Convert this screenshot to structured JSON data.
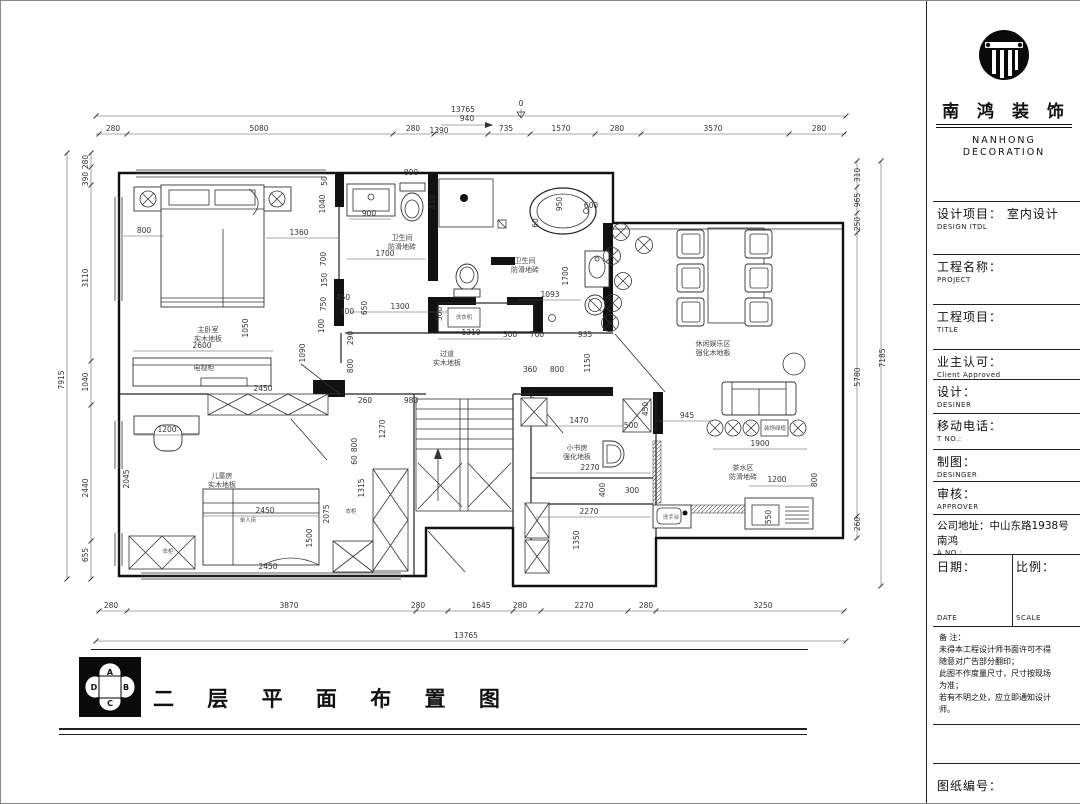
{
  "tb": {
    "company_cn": "南 鸿 装 饰",
    "company_en1": "NANHONG",
    "company_en2": "DECORATION",
    "rows": [
      {
        "label": "设计项目： 室内设计",
        "sub": "DESIGN ITDL"
      },
      {
        "label": "工程名称：",
        "sub": "PROJECT"
      },
      {
        "label": "工程项目：",
        "sub": "TITLE"
      },
      {
        "label": "业主认可：",
        "sub": "Client Approved"
      },
      {
        "label": "设计：",
        "sub": "DESINER"
      },
      {
        "label": "移动电话：",
        "sub": "T NO.:"
      },
      {
        "label": "制图：",
        "sub": "DESINGER"
      },
      {
        "label": "审核：",
        "sub": "APPROVER"
      },
      {
        "label": "公司地址：中山东路1938号南鸿",
        "sub": "A NO.:"
      }
    ],
    "date_label": "日期：",
    "date_sub": "DATE",
    "scale_label": "比例：",
    "scale_sub": "SCALE",
    "notes": "备  注：\n未得本工程设计师书面许可不得\n随意对广告部分翻印；\n此图不作度量尺寸，尺寸按现场\n为准；\n若有不明之处，应立即通知设计\n师。",
    "drawing_no_label": "图纸编号："
  },
  "footer": {
    "title": "二 层 平 面 布 置 图",
    "compass": {
      "a": "A",
      "b": "B",
      "c": "C",
      "d": "D"
    }
  },
  "plan": {
    "labels": [
      {
        "t": "13765",
        "x": 462,
        "y": 111
      },
      {
        "t": "0",
        "x": 520,
        "y": 105
      },
      {
        "t": "280",
        "x": 112,
        "y": 130
      },
      {
        "t": "5080",
        "x": 258,
        "y": 130
      },
      {
        "t": "280",
        "x": 412,
        "y": 130
      },
      {
        "t": "1390",
        "x": 438,
        "y": 132
      },
      {
        "t": "940",
        "x": 466,
        "y": 120
      },
      {
        "t": "735",
        "x": 505,
        "y": 130
      },
      {
        "t": "1570",
        "x": 560,
        "y": 130
      },
      {
        "t": "280",
        "x": 616,
        "y": 130
      },
      {
        "t": "3570",
        "x": 712,
        "y": 130
      },
      {
        "t": "280",
        "x": 818,
        "y": 130
      },
      {
        "t": "280",
        "x": 110,
        "y": 607
      },
      {
        "t": "3870",
        "x": 288,
        "y": 607
      },
      {
        "t": "280",
        "x": 417,
        "y": 607
      },
      {
        "t": "1645",
        "x": 480,
        "y": 607
      },
      {
        "t": "280",
        "x": 519,
        "y": 607
      },
      {
        "t": "2270",
        "x": 583,
        "y": 607
      },
      {
        "t": "280",
        "x": 645,
        "y": 607
      },
      {
        "t": "3250",
        "x": 762,
        "y": 607
      },
      {
        "t": "13765",
        "x": 465,
        "y": 637
      },
      {
        "t": "280",
        "x": 87,
        "y": 161,
        "r": -90
      },
      {
        "t": "390",
        "x": 87,
        "y": 178,
        "r": -90
      },
      {
        "t": "3110",
        "x": 87,
        "y": 277,
        "r": -90
      },
      {
        "t": "1040",
        "x": 87,
        "y": 381,
        "r": -90
      },
      {
        "t": "2440",
        "x": 87,
        "y": 487,
        "r": -90
      },
      {
        "t": "655",
        "x": 87,
        "y": 554,
        "r": -90
      },
      {
        "t": "7915",
        "x": 63,
        "y": 379,
        "r": -90
      },
      {
        "t": "310",
        "x": 859,
        "y": 174,
        "r": -90
      },
      {
        "t": "965",
        "x": 859,
        "y": 199,
        "r": -90
      },
      {
        "t": "250",
        "x": 859,
        "y": 223,
        "r": -90
      },
      {
        "t": "5780",
        "x": 859,
        "y": 376,
        "r": -90
      },
      {
        "t": "260",
        "x": 859,
        "y": 523,
        "r": -90
      },
      {
        "t": "7185",
        "x": 884,
        "y": 357,
        "r": -90
      },
      {
        "t": "800",
        "x": 143,
        "y": 232
      },
      {
        "t": "1360",
        "x": 298,
        "y": 234
      },
      {
        "t": "1040",
        "x": 324,
        "y": 203,
        "r": -90
      },
      {
        "t": "50",
        "x": 326,
        "y": 180,
        "r": -90
      },
      {
        "t": "700",
        "x": 325,
        "y": 258,
        "r": -90
      },
      {
        "t": "150",
        "x": 326,
        "y": 279,
        "r": -90
      },
      {
        "t": "750",
        "x": 325,
        "y": 303,
        "r": -90
      },
      {
        "t": "100",
        "x": 323,
        "y": 325,
        "r": -90
      },
      {
        "t": "1050",
        "x": 247,
        "y": 327,
        "r": -90
      },
      {
        "t": "2600",
        "x": 201,
        "y": 347
      },
      {
        "t": "1090",
        "x": 304,
        "y": 352,
        "r": -90
      },
      {
        "t": "290",
        "x": 352,
        "y": 337,
        "r": -90
      },
      {
        "t": "800",
        "x": 352,
        "y": 365,
        "r": -90
      },
      {
        "t": "900",
        "x": 368,
        "y": 215
      },
      {
        "t": "800",
        "x": 410,
        "y": 174
      },
      {
        "t": "1700",
        "x": 384,
        "y": 255
      },
      {
        "t": "450",
        "x": 342,
        "y": 299
      },
      {
        "t": "650",
        "x": 366,
        "y": 307,
        "r": -90
      },
      {
        "t": "300",
        "x": 346,
        "y": 313
      },
      {
        "t": "1300",
        "x": 399,
        "y": 308
      },
      {
        "t": "810",
        "x": 434,
        "y": 201,
        "r": -90
      },
      {
        "t": "1310",
        "x": 470,
        "y": 334
      },
      {
        "t": "500",
        "x": 441,
        "y": 313,
        "r": -90
      },
      {
        "t": "300",
        "x": 509,
        "y": 336
      },
      {
        "t": "700",
        "x": 536,
        "y": 336
      },
      {
        "t": "935",
        "x": 584,
        "y": 336
      },
      {
        "t": "1093",
        "x": 549,
        "y": 296
      },
      {
        "t": "950",
        "x": 561,
        "y": 203,
        "r": -90
      },
      {
        "t": "600",
        "x": 590,
        "y": 207
      },
      {
        "t": "60",
        "x": 537,
        "y": 222,
        "r": -90
      },
      {
        "t": "1700",
        "x": 567,
        "y": 275,
        "r": -90
      },
      {
        "t": "360",
        "x": 529,
        "y": 371
      },
      {
        "t": "800",
        "x": 556,
        "y": 371
      },
      {
        "t": "1150",
        "x": 589,
        "y": 362,
        "r": -90
      },
      {
        "t": "2450",
        "x": 262,
        "y": 390
      },
      {
        "t": "260",
        "x": 364,
        "y": 402
      },
      {
        "t": "980",
        "x": 410,
        "y": 402
      },
      {
        "t": "1270",
        "x": 384,
        "y": 428,
        "r": -90
      },
      {
        "t": "800",
        "x": 356,
        "y": 444,
        "r": -90
      },
      {
        "t": "60",
        "x": 356,
        "y": 459,
        "r": -90
      },
      {
        "t": "1200",
        "x": 166,
        "y": 431
      },
      {
        "t": "2045",
        "x": 128,
        "y": 478,
        "r": -90
      },
      {
        "t": "2450",
        "x": 264,
        "y": 512
      },
      {
        "t": "1500",
        "x": 311,
        "y": 537,
        "r": -90
      },
      {
        "t": "2075",
        "x": 328,
        "y": 513,
        "r": -90
      },
      {
        "t": "2450",
        "x": 267,
        "y": 568
      },
      {
        "t": "1315",
        "x": 363,
        "y": 487,
        "r": -90
      },
      {
        "t": "1470",
        "x": 578,
        "y": 422
      },
      {
        "t": "500",
        "x": 630,
        "y": 427
      },
      {
        "t": "2270",
        "x": 589,
        "y": 469
      },
      {
        "t": "400",
        "x": 604,
        "y": 489,
        "r": -90
      },
      {
        "t": "300",
        "x": 631,
        "y": 492
      },
      {
        "t": "2270",
        "x": 588,
        "y": 513
      },
      {
        "t": "1350",
        "x": 578,
        "y": 539,
        "r": -90
      },
      {
        "t": "450",
        "x": 647,
        "y": 408,
        "r": -90
      },
      {
        "t": "945",
        "x": 686,
        "y": 417
      },
      {
        "t": "1900",
        "x": 759,
        "y": 445
      },
      {
        "t": "1200",
        "x": 776,
        "y": 481
      },
      {
        "t": "550",
        "x": 770,
        "y": 516,
        "r": -90
      },
      {
        "t": "800",
        "x": 816,
        "y": 479,
        "r": -90
      },
      {
        "t": "主卧室",
        "x": 207,
        "y": 331,
        "c": "room"
      },
      {
        "t": "实木地板",
        "x": 207,
        "y": 340,
        "c": "room"
      },
      {
        "t": "电视柜",
        "x": 203,
        "y": 369,
        "c": "room"
      },
      {
        "t": "卫生间",
        "x": 401,
        "y": 239,
        "c": "room"
      },
      {
        "t": "防滑地砖",
        "x": 401,
        "y": 248,
        "c": "room"
      },
      {
        "t": "卫生间",
        "x": 524,
        "y": 262,
        "c": "room"
      },
      {
        "t": "防滑地砖",
        "x": 524,
        "y": 271,
        "c": "room"
      },
      {
        "t": "洗衣机",
        "x": 463,
        "y": 318,
        "c": "tiny"
      },
      {
        "t": "过道",
        "x": 446,
        "y": 355,
        "c": "room"
      },
      {
        "t": "实木地板",
        "x": 446,
        "y": 364,
        "c": "room"
      },
      {
        "t": "休闲娱乐区",
        "x": 712,
        "y": 345,
        "c": "room"
      },
      {
        "t": "强化木地板",
        "x": 712,
        "y": 354,
        "c": "room"
      },
      {
        "t": "小书房",
        "x": 576,
        "y": 449,
        "c": "room"
      },
      {
        "t": "强化地板",
        "x": 576,
        "y": 458,
        "c": "room"
      },
      {
        "t": "儿童房",
        "x": 221,
        "y": 477,
        "c": "room"
      },
      {
        "t": "实木地板",
        "x": 221,
        "y": 486,
        "c": "room"
      },
      {
        "t": "单人床",
        "x": 247,
        "y": 521,
        "c": "tiny"
      },
      {
        "t": "衣柜",
        "x": 167,
        "y": 552,
        "c": "tiny"
      },
      {
        "t": "衣柜",
        "x": 350,
        "y": 512,
        "c": "tiny"
      },
      {
        "t": "茶水区",
        "x": 742,
        "y": 469,
        "c": "room"
      },
      {
        "t": "防滑地砖",
        "x": 742,
        "y": 478,
        "c": "room"
      },
      {
        "t": "装饰绿植",
        "x": 774,
        "y": 429,
        "c": "tiny"
      },
      {
        "t": "洗手台",
        "x": 670,
        "y": 518,
        "c": "tiny"
      }
    ]
  }
}
